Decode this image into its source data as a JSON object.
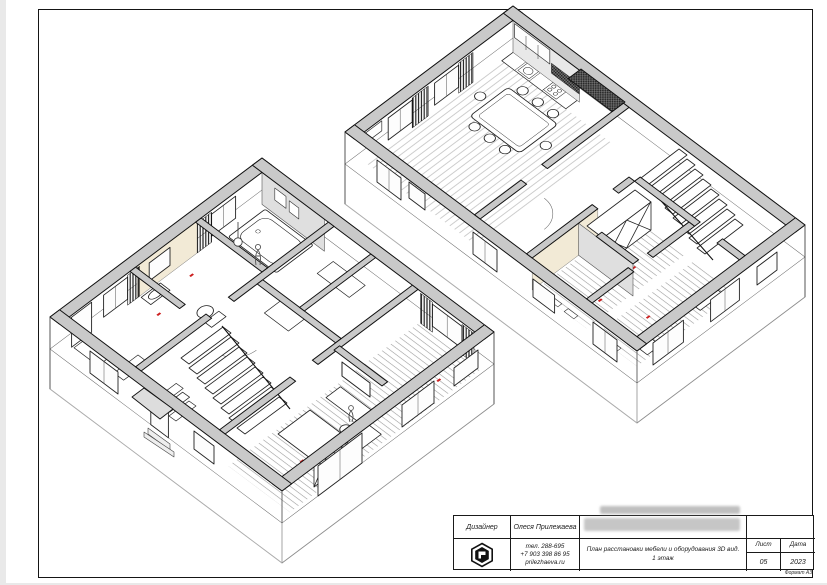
{
  "title_block": {
    "designer_label": "Дизайнер",
    "designer_name": "Олеся Прилежаева",
    "phone1": "тел. 288-695",
    "phone2": "+7 903 398 86 95",
    "website": "prilezhaeva.ru",
    "drawing_title": "План расстановки мебели и оборудования 3D вид. 1 этаж",
    "sheet_label": "Лист",
    "date_label": "Дата",
    "sheet_number": "05",
    "date_value": "2023",
    "format_label": "Формат А3"
  },
  "drawing": {
    "kind": "axonometric-cutaway-floor-plan",
    "floor": "1 этаж",
    "sections": [
      "left-wing",
      "right-wing"
    ],
    "colors": {
      "wall_cap_grey": "#c9c9c9",
      "line": "#141414",
      "accent_red": "#cc1f1f",
      "accent_cream": "#f2ead6",
      "accent_grey_wall": "#dfdfdf"
    }
  }
}
